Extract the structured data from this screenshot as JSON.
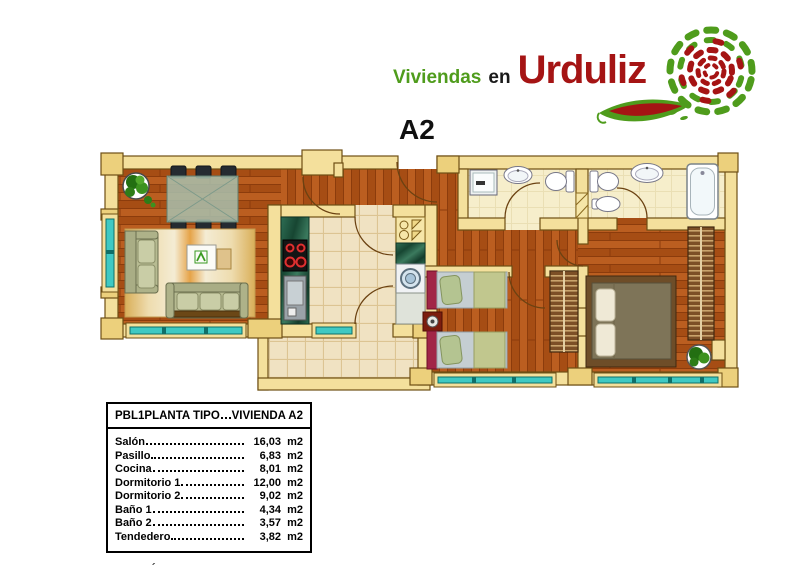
{
  "logo": {
    "word1": "Viviendas",
    "word2": "en",
    "word3": "Urduliz"
  },
  "unit_label": "A2",
  "table": {
    "header_left": "PBL1PLANTA TIPO",
    "header_right": "VIVIENDA A2",
    "rows": [
      {
        "label": "Salón",
        "value": "16,03",
        "unit": "m2"
      },
      {
        "label": "Pasillo",
        "value": "6,83",
        "unit": "m2"
      },
      {
        "label": "Cocina",
        "value": "8,01",
        "unit": "m2"
      },
      {
        "label": "Dormitorio 1",
        "value": "12,00",
        "unit": "m2"
      },
      {
        "label": "Dormitorio 2",
        "value": "9,02",
        "unit": "m2"
      },
      {
        "label": "Baño 1",
        "value": "4,34",
        "unit": "m2"
      },
      {
        "label": "Baño 2",
        "value": "3,57",
        "unit": "m2"
      },
      {
        "label": "Tendedero",
        "value": "3,82",
        "unit": "m2"
      }
    ],
    "total_label": "Metros Útiles",
    "total_value": "60,94",
    "total_unit": "m2"
  },
  "colors": {
    "logo_green": "#4f9c1c",
    "logo_red": "#a51414",
    "wall": "#f4e09c",
    "wall_outline": "#6e4f14",
    "wood_floor": "#b2571b",
    "tile_floor": "#f0e2c2",
    "window_teal": "#3fc9c3",
    "counter_green": "#1f5f46",
    "bed_headboard_red": "#a12547",
    "sofa_sage": "#b7bb92"
  },
  "icons": {
    "swirl": "spiral-leaf-logo",
    "swoosh": "leaf-swoosh",
    "plants": "potted-plant"
  }
}
